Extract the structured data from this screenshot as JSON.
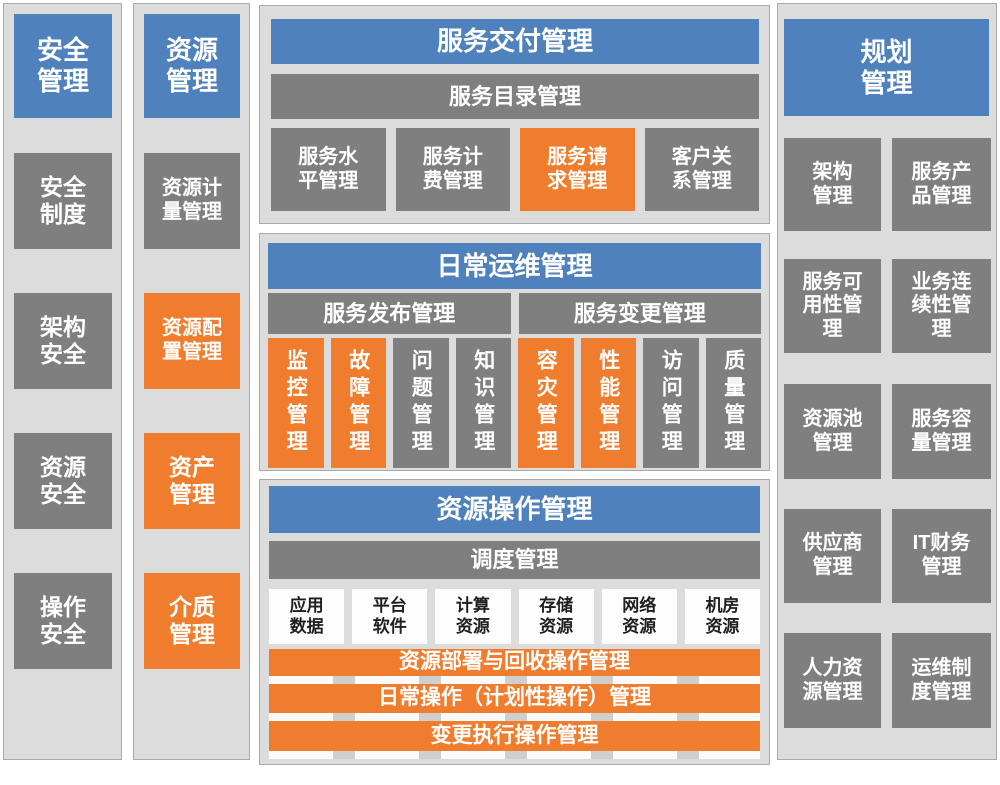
{
  "colors": {
    "blue": "#4f81bd",
    "orange": "#ef7d2d",
    "gray": "#7f7f7f",
    "panel-bg": "#dcdcdc",
    "panel-border": "#a9a9a9",
    "white-box": "#fdfdfd",
    "text-light": "#ffffff",
    "text-dark": "#1f1f1f"
  },
  "security_column": {
    "header": "安全管理",
    "items": [
      {
        "label": "安全制度",
        "variant": "gray"
      },
      {
        "label": "架构安全",
        "variant": "gray"
      },
      {
        "label": "资源安全",
        "variant": "gray"
      },
      {
        "label": "操作安全",
        "variant": "gray"
      }
    ]
  },
  "resource_column": {
    "header": "资源管理",
    "items": [
      {
        "label": "资源计量管理",
        "variant": "gray"
      },
      {
        "label": "资源配置管理",
        "variant": "orange"
      },
      {
        "label": "资产管理",
        "variant": "orange"
      },
      {
        "label": "介质管理",
        "variant": "orange"
      }
    ]
  },
  "planning_column": {
    "header": "规划管理",
    "items": [
      {
        "label": "架构管理"
      },
      {
        "label": "服务产品管理"
      },
      {
        "label": "服务可用性管理"
      },
      {
        "label": "业务连续性管理"
      },
      {
        "label": "资源池管理"
      },
      {
        "label": "服务容量管理"
      },
      {
        "label": "供应商管理"
      },
      {
        "label": "IT财务管理"
      },
      {
        "label": "人力资源管理"
      },
      {
        "label": "运维制度管理"
      }
    ]
  },
  "service_delivery": {
    "title": "服务交付管理",
    "catalog_bar": "服务目录管理",
    "boxes": [
      {
        "label": "服务水平管理",
        "variant": "gray"
      },
      {
        "label": "服务计费管理",
        "variant": "gray"
      },
      {
        "label": "服务请求管理",
        "variant": "orange"
      },
      {
        "label": "客户关系管理",
        "variant": "gray"
      }
    ]
  },
  "daily_ops": {
    "title": "日常运维管理",
    "bars": [
      {
        "label": "服务发布管理"
      },
      {
        "label": "服务变更管理"
      }
    ],
    "boxes": [
      {
        "label": "监控管理",
        "variant": "orange"
      },
      {
        "label": "故障管理",
        "variant": "orange"
      },
      {
        "label": "问题管理",
        "variant": "gray"
      },
      {
        "label": "知识管理",
        "variant": "gray"
      },
      {
        "label": "容灾管理",
        "variant": "orange"
      },
      {
        "label": "性能管理",
        "variant": "orange"
      },
      {
        "label": "访问管理",
        "variant": "gray"
      },
      {
        "label": "质量管理",
        "variant": "gray"
      }
    ]
  },
  "resource_ops": {
    "title": "资源操作管理",
    "schedule_bar": "调度管理",
    "resource_boxes": [
      {
        "label": "应用数据"
      },
      {
        "label": "平台软件"
      },
      {
        "label": "计算资源"
      },
      {
        "label": "存储资源"
      },
      {
        "label": "网络资源"
      },
      {
        "label": "机房资源"
      }
    ],
    "operation_bars": [
      {
        "label": "资源部署与回收操作管理"
      },
      {
        "label": "日常操作（计划性操作）管理"
      },
      {
        "label": "变更执行操作管理"
      }
    ]
  }
}
